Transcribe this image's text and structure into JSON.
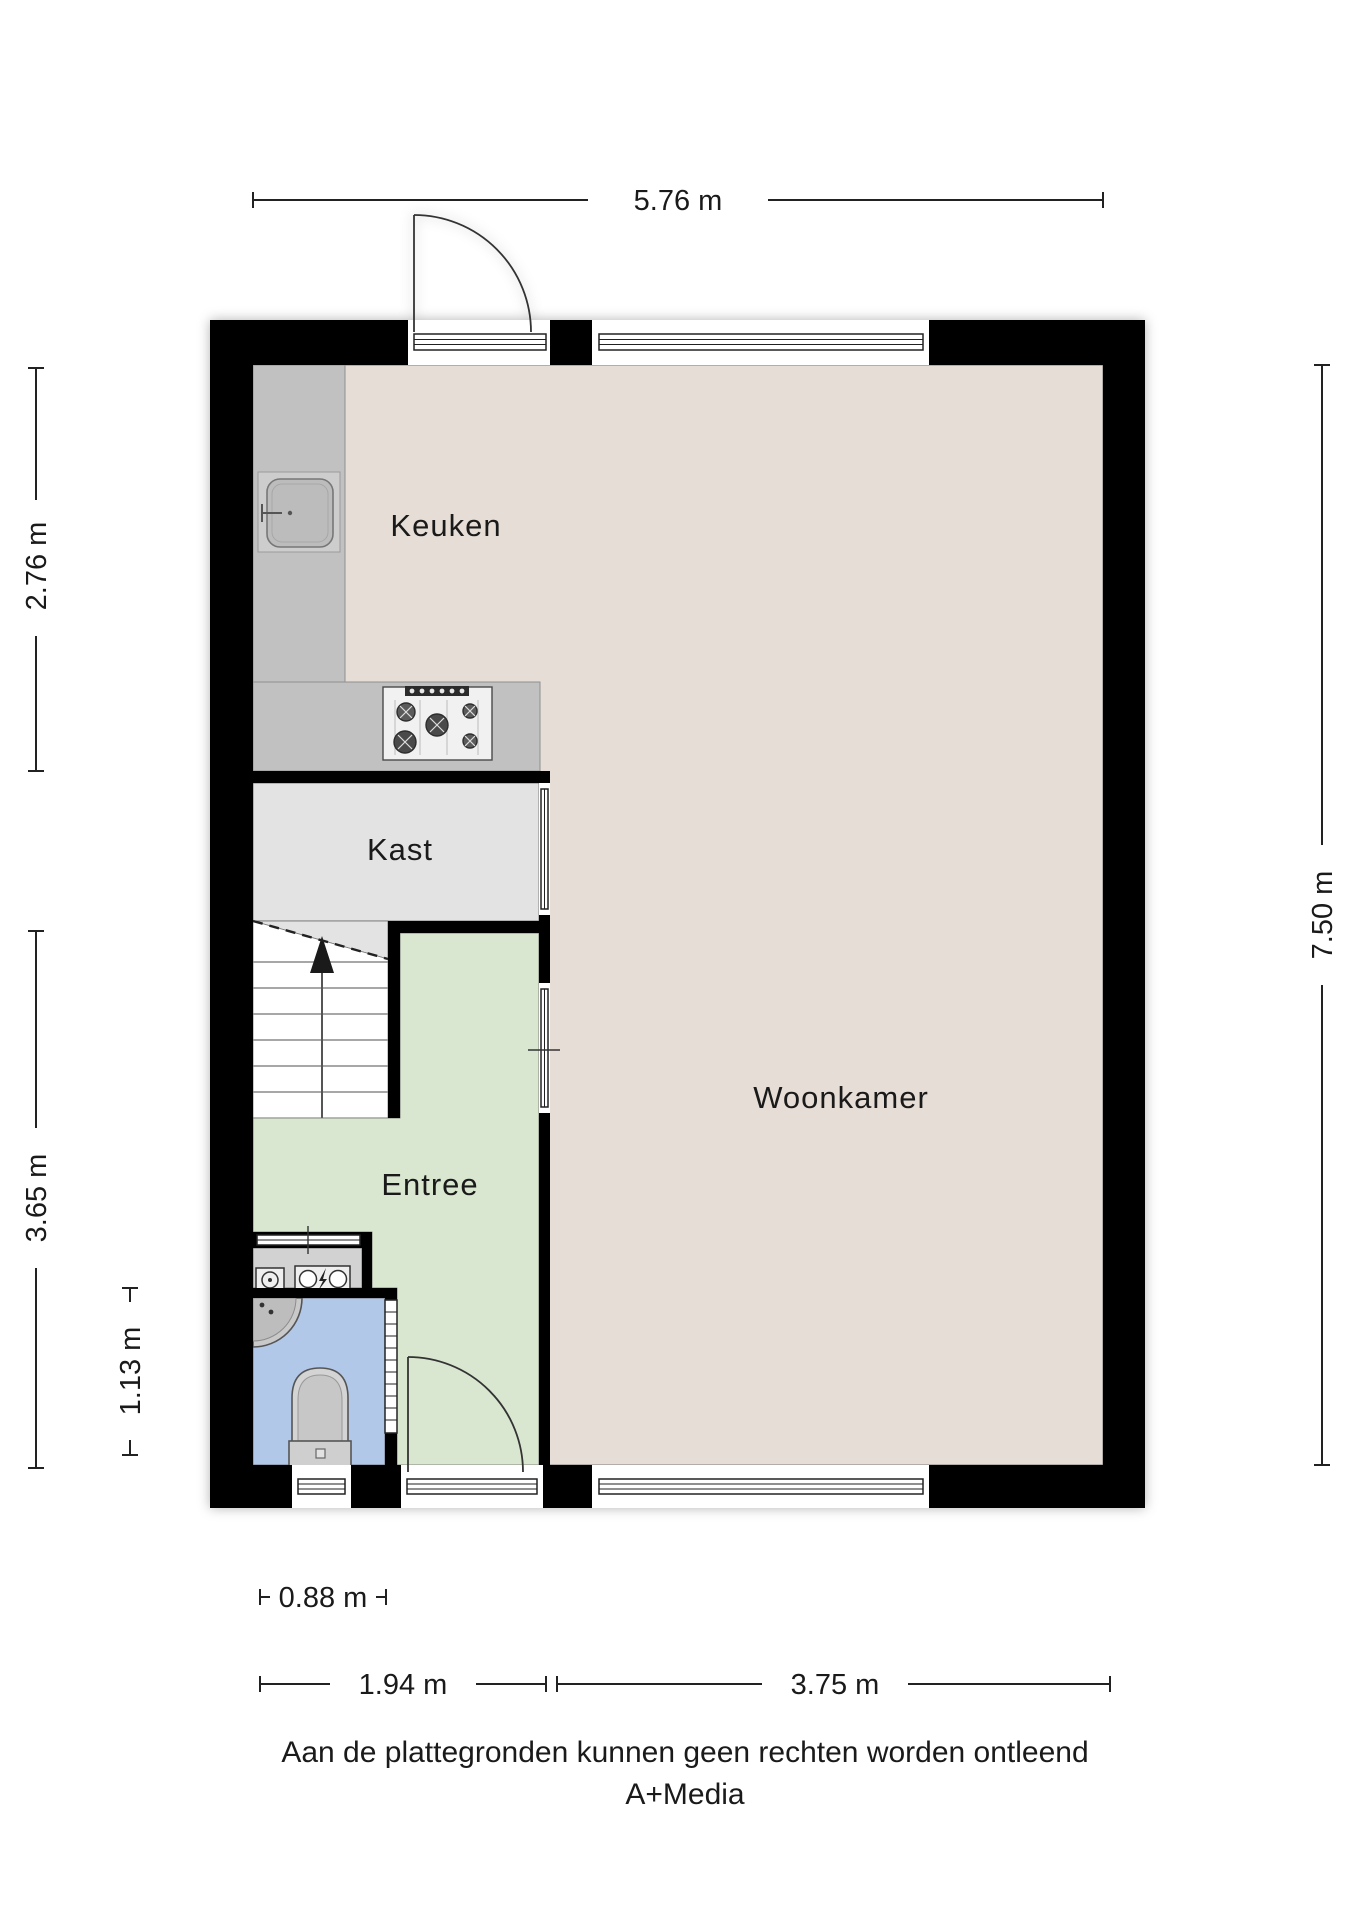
{
  "plan": {
    "rooms": {
      "keuken": {
        "label": "Keuken"
      },
      "kast": {
        "label": "Kast"
      },
      "woonkamer": {
        "label": "Woonkamer"
      },
      "entree": {
        "label": "Entree"
      }
    },
    "dimensions": {
      "top": "5.76 m",
      "left_top": "2.76 m",
      "left_middle": "3.65 m",
      "left_bottom": "1.13 m",
      "right": "7.50 m",
      "bottom_small": "0.88 m",
      "bottom_left": "1.94 m",
      "bottom_right": "3.75 m"
    },
    "colors": {
      "wall": "#000000",
      "floor_living": "#e6ddd6",
      "floor_kast": "#e3e3e3",
      "floor_entree": "#d9e7d1",
      "floor_toilet": "#b2c8e8",
      "floor_meter": "#d2d2d2",
      "counter": "#c1c1c1"
    }
  },
  "footer": {
    "disclaimer": "Aan de plattegronden kunnen geen rechten worden ontleend",
    "brand": "A+Media"
  }
}
